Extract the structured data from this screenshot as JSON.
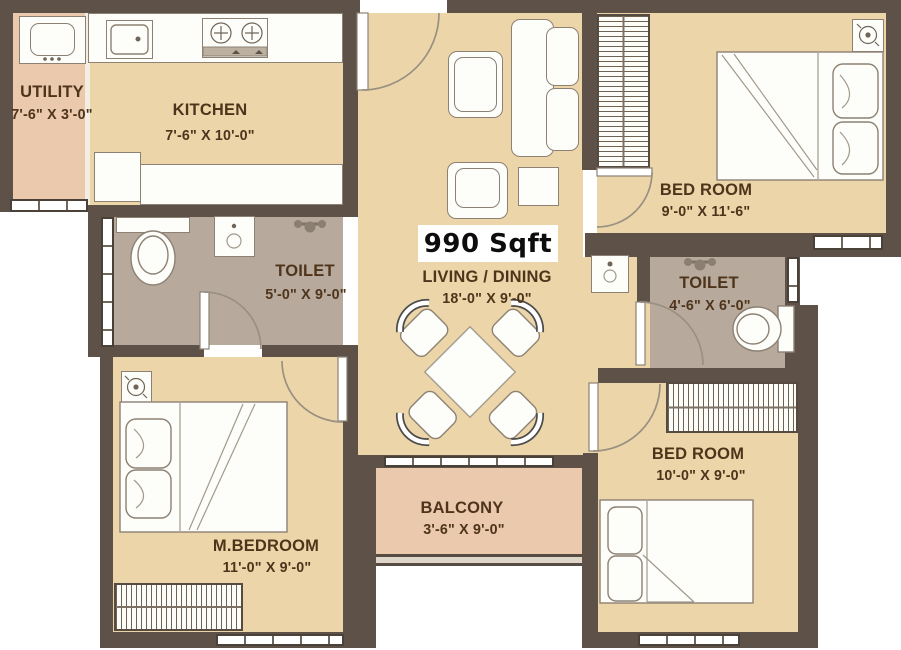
{
  "plan": {
    "total_area": "990 Sqft",
    "rooms": [
      {
        "id": "utility",
        "name": "UTILITY",
        "dims": "7'-6\" X 3'-0\""
      },
      {
        "id": "kitchen",
        "name": "KITCHEN",
        "dims": "7'-6\" X 10'-0\""
      },
      {
        "id": "bedroom1",
        "name": "BED ROOM",
        "dims": "9'-0\" X 11'-6\""
      },
      {
        "id": "toilet1",
        "name": "TOILET",
        "dims": "5'-0\" X 9'-0\""
      },
      {
        "id": "living",
        "name": "LIVING / DINING",
        "dims": "18'-0\" X 9'-0\""
      },
      {
        "id": "toilet2",
        "name": "TOILET",
        "dims": "4'-6\" X 6'-0\""
      },
      {
        "id": "mbedroom",
        "name": "M.BEDROOM",
        "dims": "11'-0\" X 9'-0\""
      },
      {
        "id": "balcony",
        "name": "BALCONY",
        "dims": "3'-6\" X 9'-0\""
      },
      {
        "id": "bedroom2",
        "name": "BED ROOM",
        "dims": "10'-0\" X 9'-0\""
      }
    ],
    "colors": {
      "wall": "#5d5148",
      "floor_tan": "#ecd6a9",
      "floor_pink": "#eac9ac",
      "floor_toilet": "#b7aa9d",
      "label_text": "#4f341c",
      "area_badge_bg": "#ffffff",
      "area_badge_text": "#0d0d0d"
    },
    "icons": [
      "washing-machine-icon",
      "kitchen-sink-icon",
      "stove-icon",
      "refrigerator-icon",
      "toilet-wc-icon",
      "washbasin-icon",
      "shower-mixer-icon",
      "ceiling-fan-icon",
      "double-bed-icon",
      "wardrobe-icon",
      "sofa-icon",
      "coffee-table-icon",
      "side-table-icon",
      "dining-table-icon",
      "door-swing-icon",
      "window-icon",
      "balcony-railing-icon"
    ]
  }
}
